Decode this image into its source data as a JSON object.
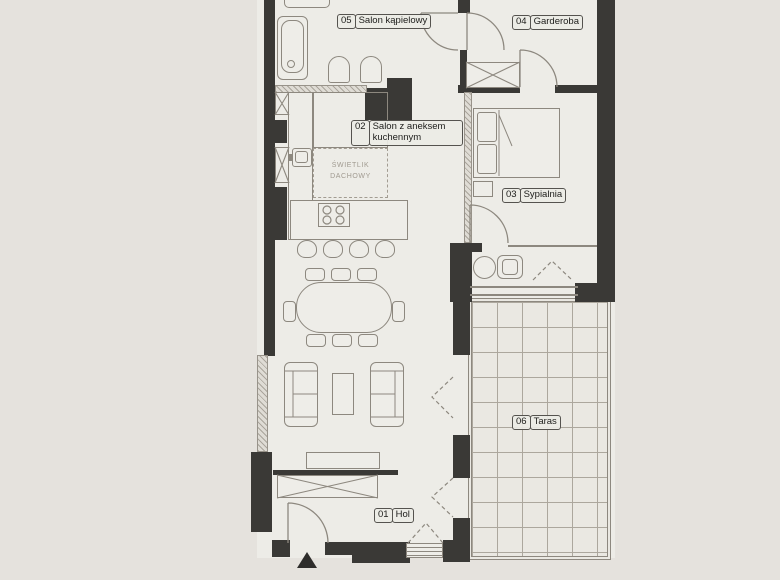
{
  "rooms": [
    {
      "id": "01",
      "name": "Hol"
    },
    {
      "id": "02",
      "name": "Salon z aneksem kuchennym"
    },
    {
      "id": "03",
      "name": "Sypialnia"
    },
    {
      "id": "04",
      "name": "Garderoba"
    },
    {
      "id": "05",
      "name": "Salon kąpielowy"
    },
    {
      "id": "06",
      "name": "Taras"
    }
  ],
  "skylight": {
    "line1": "ŚWIETLIK",
    "line2": "DACHOWY"
  },
  "colors": {
    "background": "#e5e2dd",
    "floor": "#edece7",
    "wall": "#3a3936",
    "line": "#8d887f",
    "terrace_floor": "#eae8e2",
    "label_border": "#55534f",
    "label_text": "#1d1d1b",
    "muted_text": "#a09a90"
  }
}
